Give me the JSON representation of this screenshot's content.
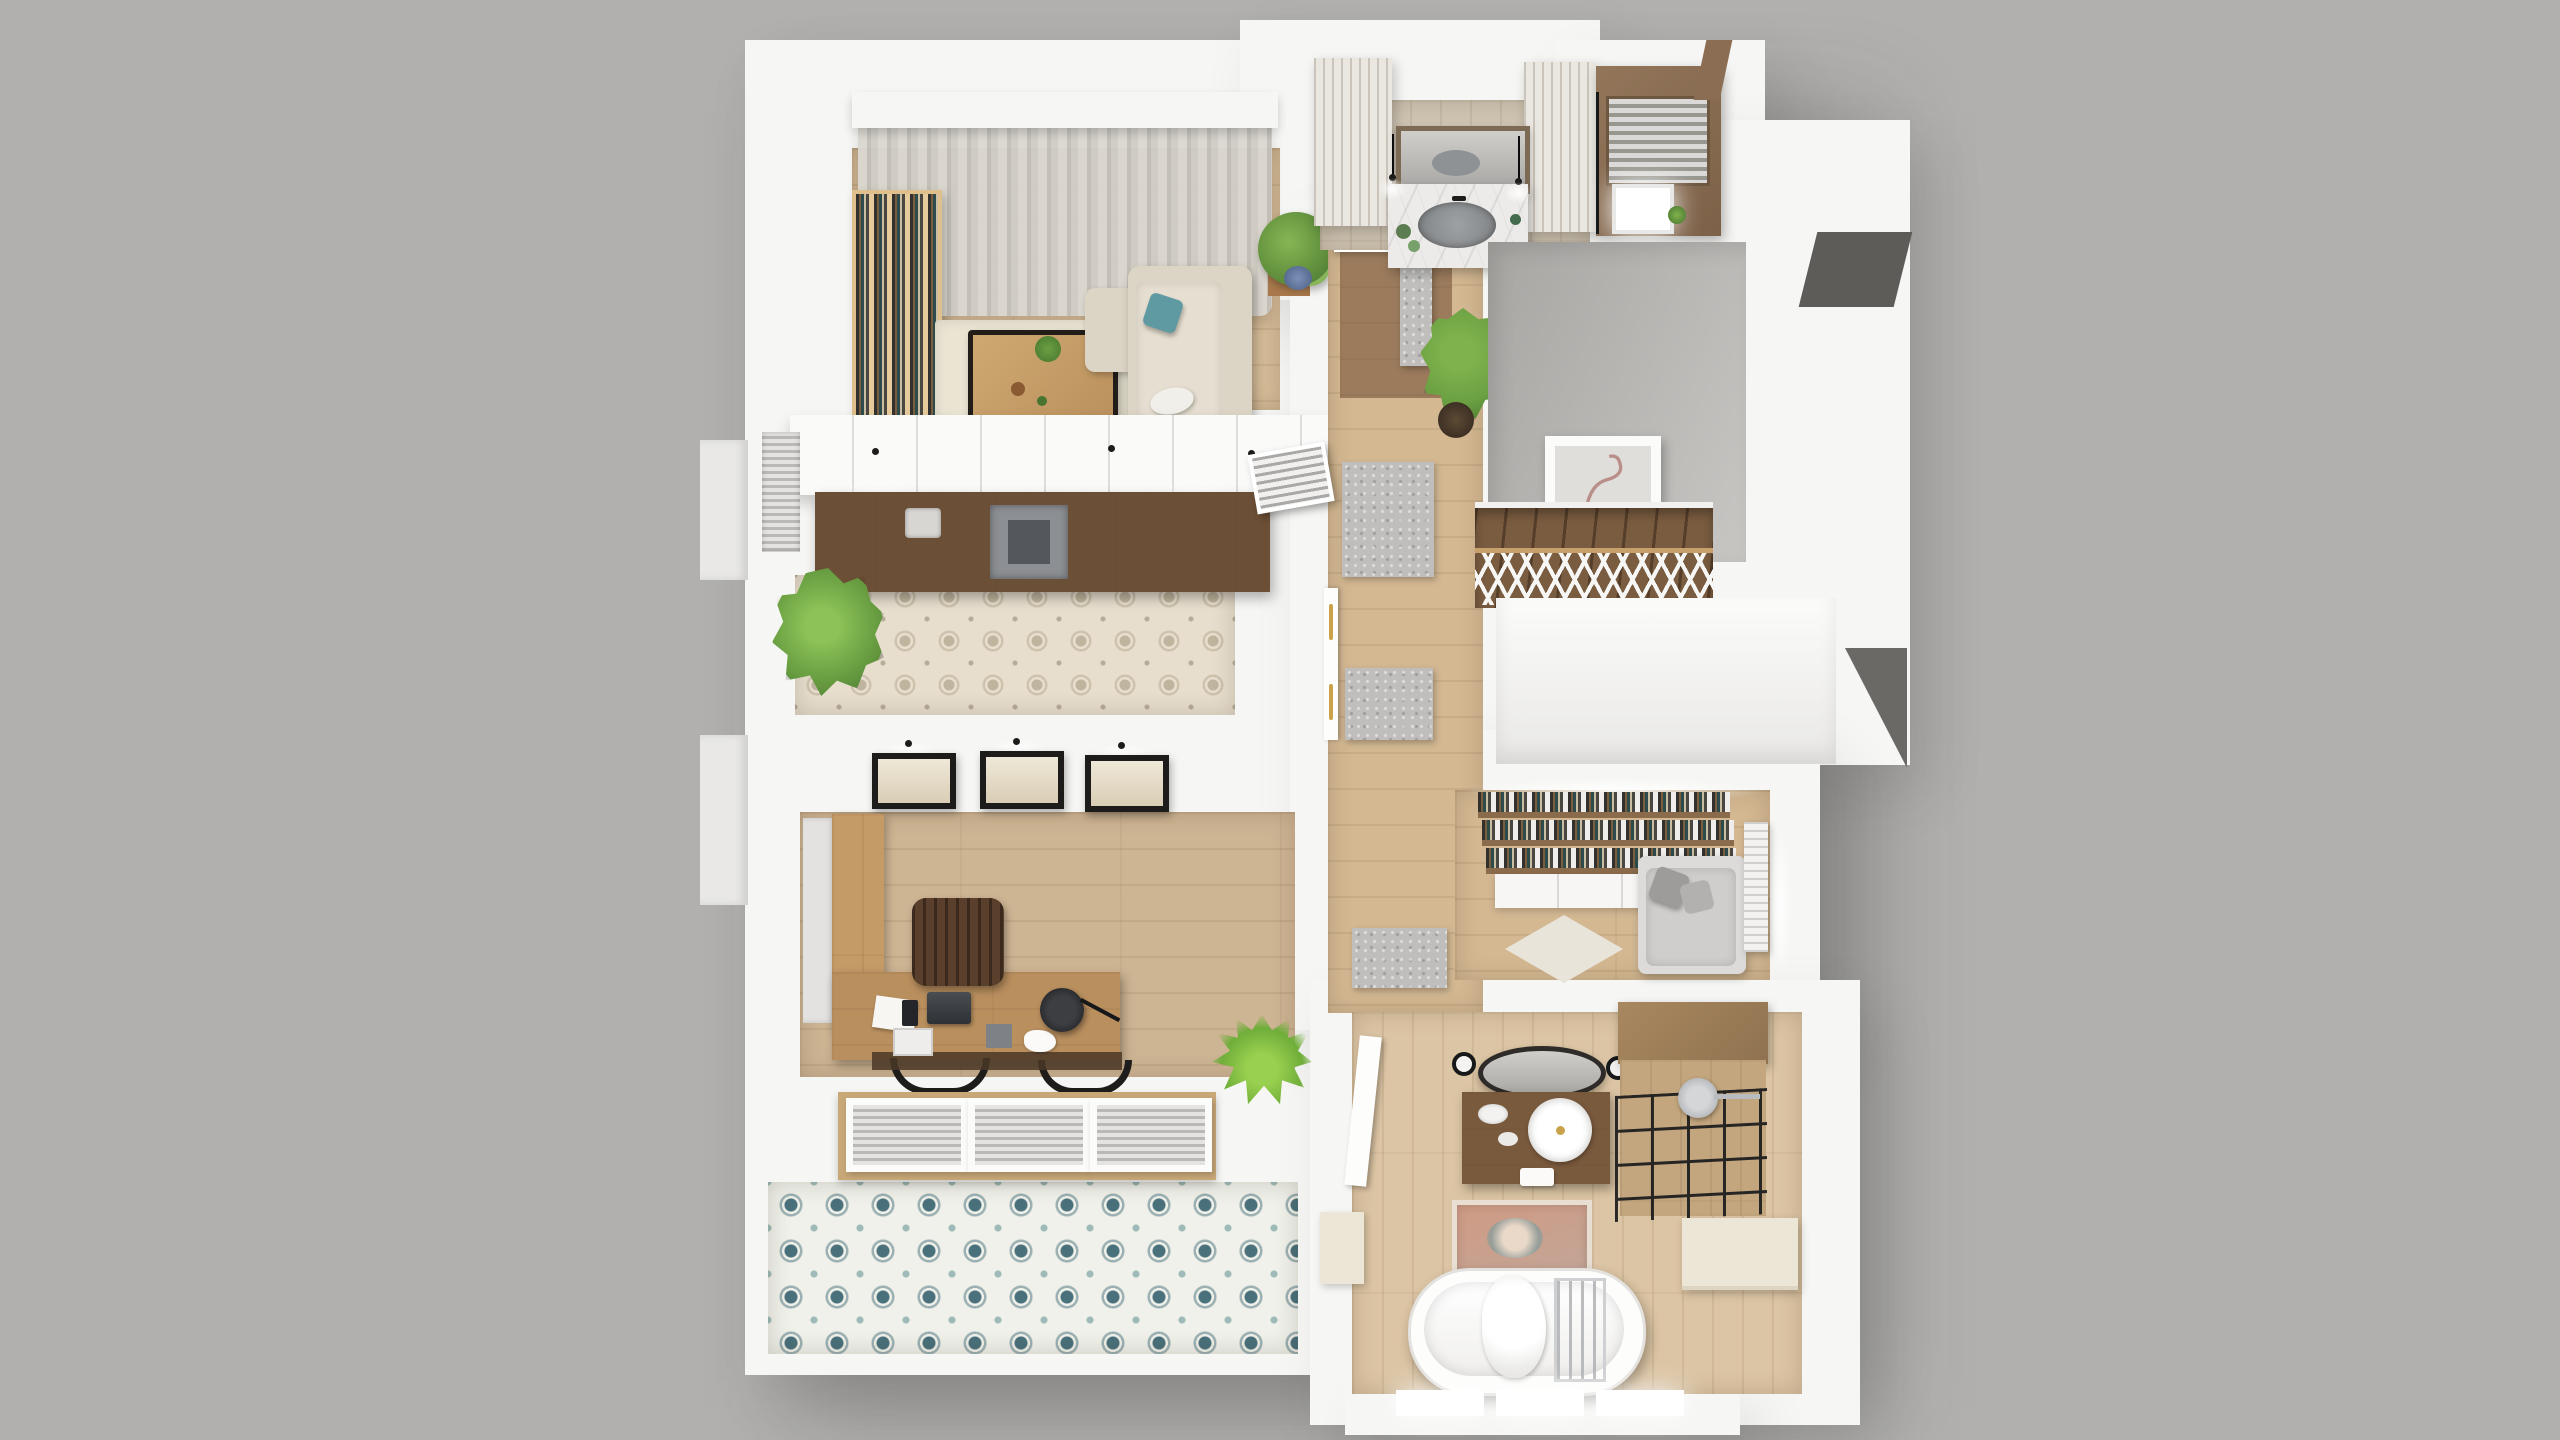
{
  "scene": {
    "kind": "3d-floor-plan-render",
    "view": "top-down axonometric dollhouse view of a single apartment level",
    "background": "plain gray studio backdrop",
    "visible_text": "none"
  },
  "palette": {
    "bg": "#b1b0ae",
    "wall": "#f6f6f4",
    "wall-dim": "#e9e8e6",
    "wood-light": "#d6bc98",
    "wood-hall": "#d3b892",
    "wood-office": "#cdb493",
    "wood-bath": "#dcc5a4",
    "wood-dark": "#6e5137",
    "wood-stair": "#7a5c40",
    "wood-entry": "#9b7b5c",
    "pine": "#e6cb9c",
    "counter": "#6b4f36",
    "marble": "#edebe9",
    "sink": "#8f9294",
    "curtain-a": "#dbd8d1",
    "curtain-b": "#c3c0b9",
    "sofa": "#dcd5c6",
    "teal": "#5f9aa3",
    "ruggray": "#bfbebd",
    "plant": "#6ba043",
    "plant-dark": "#47742e",
    "ink": "#1d1c1a",
    "gold": "#c9a24a",
    "cream": "#ece6d7",
    "landing-a": "#a8a6a3",
    "landing-b": "#c8c6c3",
    "tileK": "#e7decd",
    "tileB": "#eff1ea",
    "tileBa": "#49707b",
    "glass": "#17181a",
    "shutter": "#eae7e1",
    "roof-dark": "#5e5c59"
  },
  "rooms": [
    {
      "id": "living-room",
      "label": "Living room",
      "floor": "light oak planks",
      "furniture": [
        "curtain rail box",
        "sheer gray curtains",
        "pine bookshelf with books",
        "beige corner sofa",
        "teal pillow",
        "white pillow",
        "live-edge coffee table",
        "cream area rug",
        "potted plant on wood stand"
      ]
    },
    {
      "id": "kitchen",
      "label": "Kitchen",
      "floor": "ornamental beige cement tile",
      "furniture": [
        "white upper cabinet run with downlights",
        "dark walnut countertop",
        "gray cooktop",
        "counter sink",
        "window blinds",
        "palm plant"
      ]
    },
    {
      "id": "hallway",
      "label": "Hallway",
      "floor": "light wood planks",
      "furniture": [
        "three gray shag rugs",
        "potted palm",
        "entry vestibule in dark wood tile",
        "double door with brass handles",
        "louvered vent door"
      ]
    },
    {
      "id": "bathroom-top",
      "label": "Master bathroom",
      "floor": "rustic boards",
      "furniture": [
        "marble vanity counter",
        "oval gray sink",
        "wood framed mirror with reflected sink",
        "two black pendant lights",
        "two distressed shutter cabinets",
        "green glass jars"
      ]
    },
    {
      "id": "shower-room",
      "label": "Shower / sauna cabin",
      "floor": "warm wood",
      "furniture": [
        "wood clad walls",
        "slatted screen roof",
        "bright skylight opening"
      ]
    },
    {
      "id": "stairwell",
      "label": "Stairwell",
      "floor": "gray landing",
      "furniture": [
        "white framed flamingo sketch",
        "dark wood staircase",
        "white cross-braced railing with wood handrail"
      ]
    },
    {
      "id": "library",
      "label": "Library nook",
      "floor": "wood planks with pale rug",
      "furniture": [
        "full wall bookshelves",
        "white base cabinets",
        "window seat with gray cushions",
        "two gray pillows",
        "white radiator",
        "bright window"
      ]
    },
    {
      "id": "office",
      "label": "Home office",
      "floor": "wide rustic oak planks",
      "furniture": [
        "three black framed prints with picture lights",
        "L-shaped walnut desk",
        "wooden slat chair",
        "two tucked chairs",
        "black desk lamp",
        "laptop",
        "papers",
        "phone",
        "storage boxes",
        "dark runner",
        "grass plant"
      ]
    },
    {
      "id": "balcony",
      "label": "Balcony",
      "floor": "teal rosette patterned tile",
      "furniture": [
        "triple glazed window wall with blinds",
        "wood sill"
      ]
    },
    {
      "id": "bathroom-bottom",
      "label": "Family bathroom",
      "floor": "pale wood planks",
      "furniture": [
        "open white entry door",
        "reclaimed wood vanity",
        "round white vessel sink",
        "oval black rimmed mirror",
        "two wall sconces",
        "black framed glass shower with wood walls",
        "rain shower head",
        "faded oriental rug",
        "freestanding white bathtub with towel",
        "chrome tub caddy",
        "cream cabinet",
        "three lit windows in outer wall"
      ]
    },
    {
      "id": "exterior",
      "label": "Building exterior",
      "furniture": [
        "white parapet ledges",
        "dark roof patches",
        "ground shadow"
      ]
    }
  ]
}
